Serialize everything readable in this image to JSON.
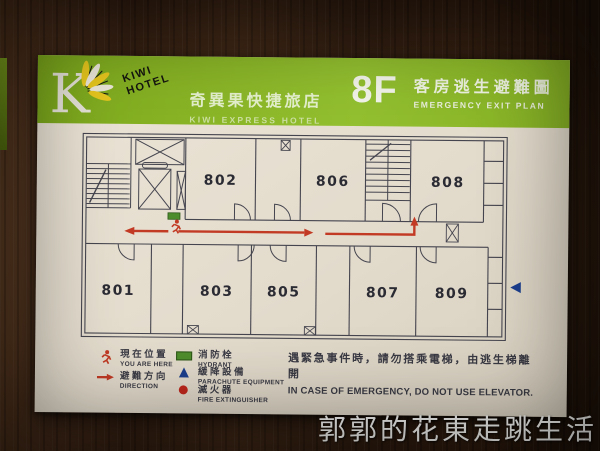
{
  "colors": {
    "band_green": "#86b226",
    "arrow_red": "#c23a24",
    "hydrant_green": "#4e8d2c",
    "parachute_blue": "#1c3f8e",
    "extinguisher_red": "#c0271c",
    "plan_line": "#45454f",
    "board_cream": "#e6dfd0",
    "wood_brown": "#43271​4"
  },
  "sign": {
    "header": {
      "logo_letter": "K",
      "brand_line1": "KIWI",
      "brand_line2": "HOTEL",
      "hotel_name_zh": "奇異果快捷旅店",
      "hotel_name_en": "KIWI EXPRESS HOTEL",
      "floor_label": "8F",
      "plan_title_zh": "客房逃生避難圖",
      "plan_title_en": "EMERGENCY EXIT PLAN"
    },
    "floor_plan": {
      "rooms": [
        "802",
        "806",
        "808",
        "801",
        "803",
        "805",
        "807",
        "809"
      ]
    },
    "legend": {
      "items": [
        {
          "icon": "running-man-icon",
          "zh": "現在位置",
          "en": "YOU ARE HERE"
        },
        {
          "icon": "direction-arrow-icon",
          "zh": "避難方向",
          "en": "DIRECTION"
        },
        {
          "icon": "hydrant-icon",
          "zh": "消防栓",
          "en": "HYDRANT"
        },
        {
          "icon": "parachute-icon",
          "zh": "緩降設備",
          "en": "PARACHUTE EQUIPMENT"
        },
        {
          "icon": "fire-extinguisher-icon",
          "zh": "滅火器",
          "en": "FIRE EXTINGUISHER"
        }
      ]
    },
    "notice": {
      "zh": "遇緊急事件時，請勿搭乘電梯，由逃生梯離開",
      "en": "IN CASE OF EMERGENCY, DO NOT USE ELEVATOR."
    }
  },
  "watermark": "郭郭的花東走跳生活"
}
